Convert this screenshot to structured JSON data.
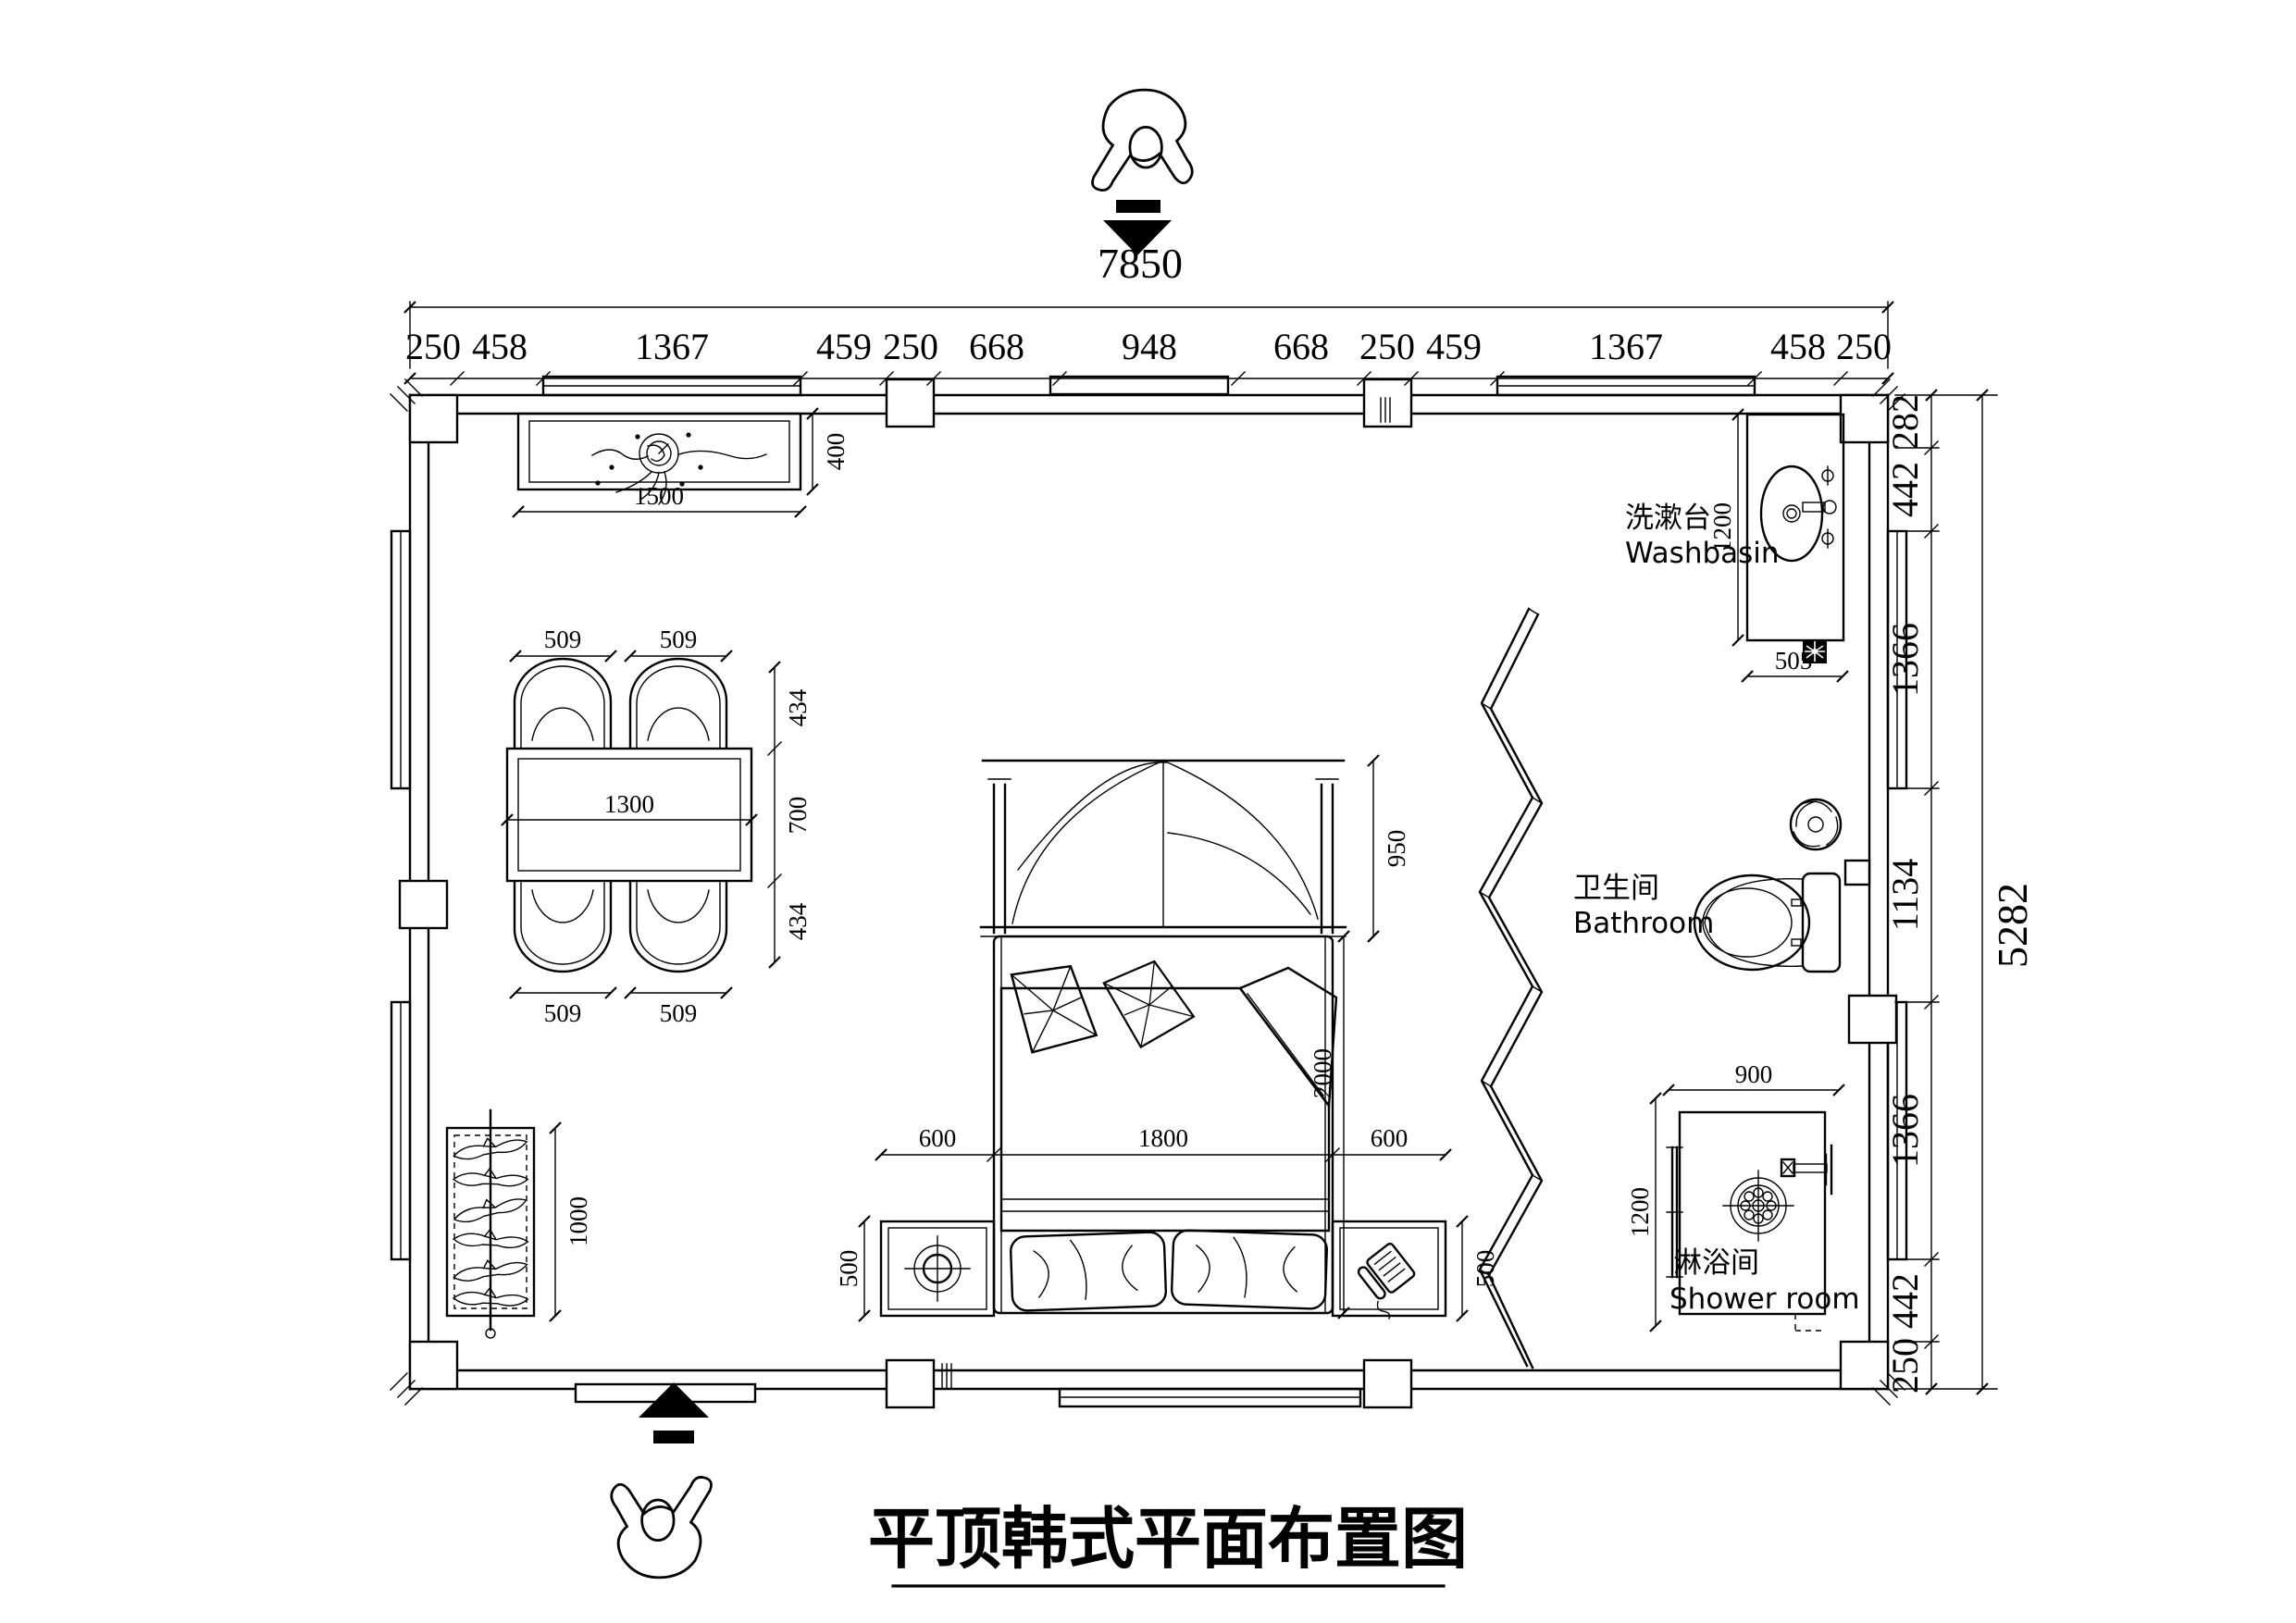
{
  "title": "平顶韩式平面布置图",
  "rooms": {
    "washbasin": {
      "zh": "洗漱台",
      "en": "Washbasin"
    },
    "bathroom": {
      "zh": "卫生间",
      "en": "Bathroom"
    },
    "shower": {
      "zh": "淋浴间",
      "en": "Shower room"
    }
  },
  "dims": {
    "top_total": "7850",
    "top_segments": [
      "250",
      "458",
      "1367",
      "459",
      "250",
      "668",
      "948",
      "668",
      "250",
      "459",
      "1367",
      "458",
      "250"
    ],
    "right_total": "5282",
    "right_segments": [
      "282",
      "442",
      "1366",
      "1134",
      "1366",
      "442",
      "250"
    ],
    "counter": {
      "w": "1500",
      "d": "400"
    },
    "table": {
      "w": "1300",
      "d": "700",
      "chair_w": "509",
      "chair_d": "434"
    },
    "bed": {
      "w": "1800",
      "l": "2000",
      "canopy": "950",
      "stand_w": "600",
      "stand_d": "500"
    },
    "wardrobe": {
      "l": "1000"
    },
    "washbasin": {
      "l": "1200",
      "w": "505"
    },
    "shower": {
      "w": "900",
      "d": "1200"
    }
  }
}
